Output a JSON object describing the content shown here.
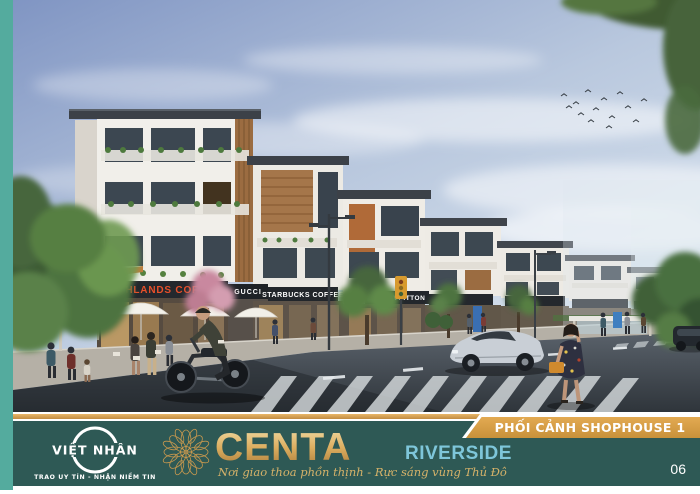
{
  "frame": {
    "accent_bar_color": "#54ab9e",
    "footer_color": "#2e5955",
    "stripe_gold": "#d8a055",
    "page_background": "#ffffff"
  },
  "photo": {
    "shop_signs": {
      "highlands": "HIGHLANDS COFFEE",
      "gucci": "GUCCI",
      "starbucks": "STARBUCKS COFFEE",
      "louis_vuitton": "LOUIS VUITTON"
    },
    "sign_colors": {
      "highlands_text": "#e8502a",
      "default_text": "#ffffff"
    }
  },
  "banner": {
    "label": "PHỐI CẢNH SHOPHOUSE 1",
    "background": "#d99b3c",
    "text_color": "#ffffff"
  },
  "footer": {
    "developer": {
      "name": "VIỆT NHÂN",
      "tagline": "TRAO UY TÍN - NHẬN NIỀM TIN"
    },
    "brand": {
      "name": "CENTA",
      "suffix": "RIVERSIDE",
      "suffix_color": "#7ec6da",
      "gold_color": "#d8ab5e",
      "slogan": "Nơi giao thoa phồn thịnh - Rực sáng vùng Thủ Đô"
    },
    "page_number": "06"
  }
}
